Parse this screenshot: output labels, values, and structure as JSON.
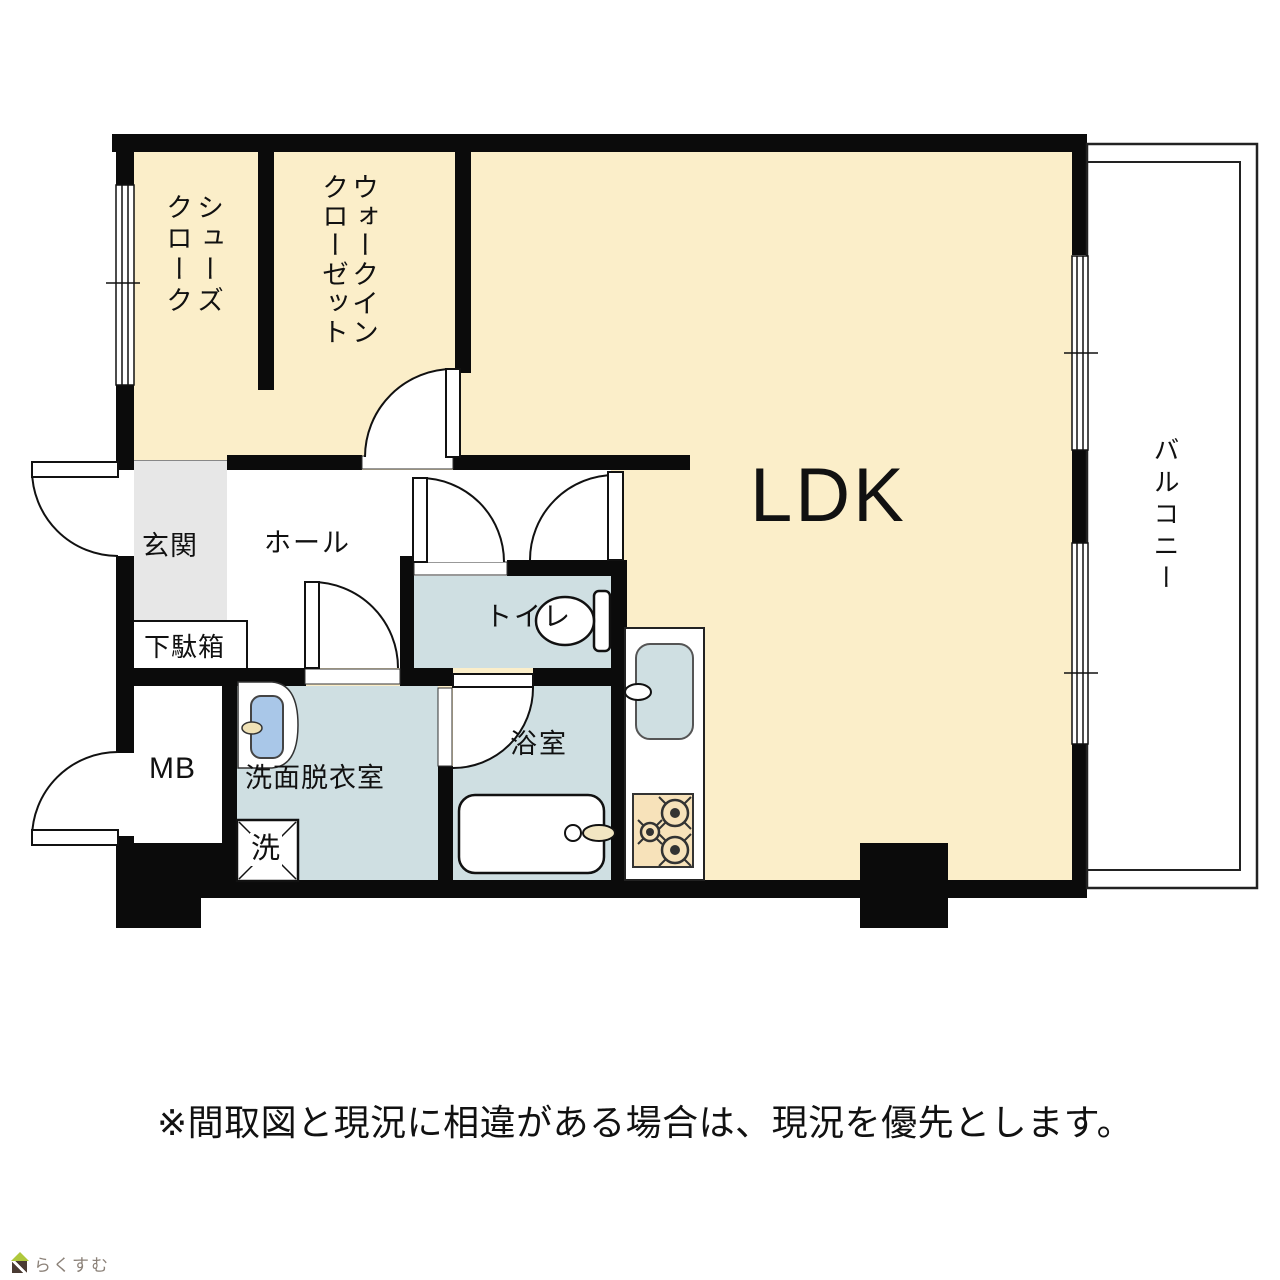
{
  "rooms": {
    "shoes_closet": {
      "label": "シューズ\nクローク"
    },
    "walk_in_closet": {
      "label": "ウォークイン\nクローゼット"
    },
    "ldk": {
      "label": "LDK"
    },
    "balcony": {
      "label": "バルコニー"
    },
    "entrance": {
      "label": "玄関"
    },
    "hall": {
      "label": "ホール"
    },
    "shoe_cabinet": {
      "label": "下駄箱"
    },
    "toilet": {
      "label": "トイレ"
    },
    "meter_box": {
      "label": "MB"
    },
    "washroom": {
      "label": "洗面脱衣室"
    },
    "bathroom": {
      "label": "浴室"
    },
    "washer": {
      "label": "洗"
    }
  },
  "notes": {
    "disclaimer": "※間取図と現況に相違がある場合は、現況を優先とします。"
  },
  "logo": {
    "text": "らくすむ"
  },
  "colors": {
    "room_beige": "#FBEEC9",
    "wet_room_blue": "#CFDFE2",
    "entrance_gray": "#E7E7E7",
    "basin_blue": "#A9C7E8",
    "stove_tan": "#F7E2BA",
    "fixture_cream": "#F2E6C2",
    "wall_black": "#0B0B0B",
    "logo_green": "#AFC83C",
    "logo_brown": "#4A3B33",
    "logo_text_gray": "#8B8178"
  }
}
